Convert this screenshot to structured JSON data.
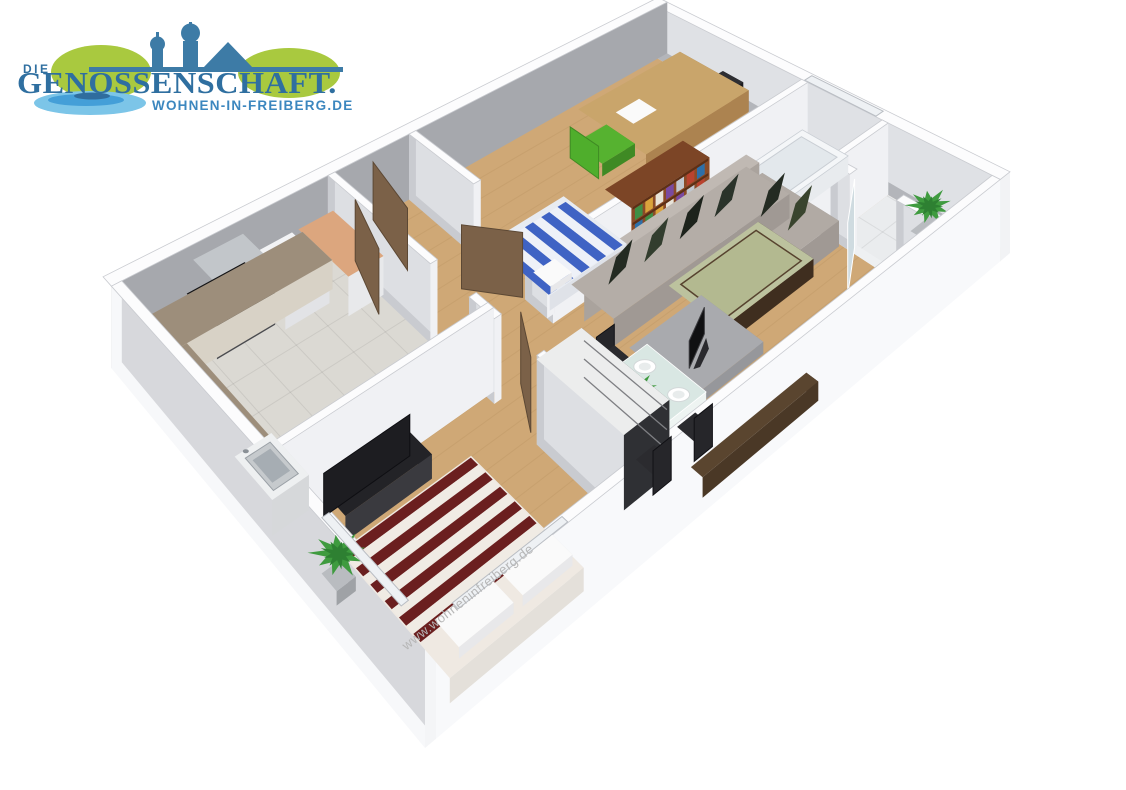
{
  "logo": {
    "die": "DIE",
    "title": "GENOSSENSCHAFT.",
    "domain": "WOHNEN-IN-FREIBERG.DE"
  },
  "watermark": {
    "text": "www.wohneninfreiberg.de"
  },
  "colors": {
    "logo_blue": "#2f6fa0",
    "logo_green": "#a9c93f",
    "logo_water": "#7cc5e8",
    "logo_water_dark": "#449fd8",
    "watermark_grey": "#b6b6b6",
    "wood": "#cfa876",
    "wall_top": "#fcfcfd",
    "wall_face": "#eff1f3",
    "wall_shadow": "#a6a8ad",
    "tile_kitchen": "#dbd9d3",
    "tile_bath": "#e7e9ec",
    "tile_balcony": "#eaecee",
    "door_brown": "#7b6148",
    "door_edge": "#5c4834",
    "glass_door": "#cfdbe0",
    "counter_top": "#9d8e7b",
    "counter_front": "#d8d2c6",
    "stove": "#141416",
    "hood": "#b3b7bb",
    "sink_steel": "#c6cacd",
    "peach_top": "#dca67e",
    "cabinet_white": "#f2f3f5",
    "bed_red": "#6b1f1f",
    "bed_red_stripe": "#f0ebe4",
    "pillow_white": "#fafafa",
    "bench_black": "#232327",
    "wardrobe_dark": "#3b3c40",
    "wardrobe_top": "#eceded",
    "sofa_grey": "#b4ada7",
    "sofa_dark": "#a09994",
    "cushion_dark": "#242b22",
    "coffee_top": "#bcc29e",
    "coffee_frame": "#3f2e1f",
    "tv_black": "#101012",
    "pedestal_grey": "#a9aaae",
    "table_glass": "#d9e7e3",
    "plate_white": "#ffffff",
    "chair_black": "#26262a",
    "radiator_brown": "#5a452f",
    "bookshelf_brown": "#8a4b28",
    "bookshelf_dark": "#5f3018",
    "desk_tan": "#c9a56b",
    "desk_side": "#ac8350",
    "chair_green": "#56b230",
    "ball_blue": "#4b86ba",
    "duvet_blue": "#3f63c4",
    "duvet_white": "#eef1f8",
    "plant_green": "#3f9b3f",
    "plant_dark": "#2e8032",
    "tub_white": "#f4f6f8"
  },
  "floorplan": {
    "type": "3d-floorplan-render",
    "rooms": [
      {
        "name": "kitchen"
      },
      {
        "name": "hallway"
      },
      {
        "name": "study"
      },
      {
        "name": "living-dining-room"
      },
      {
        "name": "bedroom"
      },
      {
        "name": "bathroom"
      },
      {
        "name": "balcony"
      }
    ]
  }
}
